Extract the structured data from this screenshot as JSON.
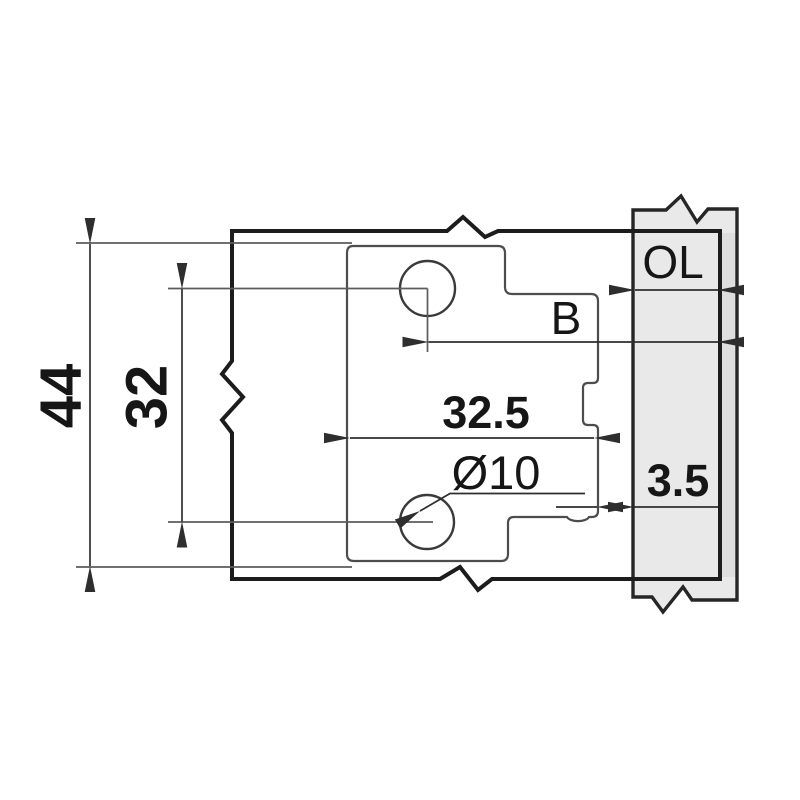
{
  "drawing": {
    "kind": "hinge-mounting-plate-dimension-diagram",
    "labels": {
      "plate_height": "44",
      "hole_spacing": "32",
      "plate_setback": "32.5",
      "hole_diameter": "Ø10",
      "boring_distance": "B",
      "overlay": "OL",
      "gap_offset": "3.5"
    },
    "colors": {
      "background": "#ffffff",
      "panel_fill": "#e9e9e9",
      "panel_edge_fill": "#dedede",
      "door_outline": "#1c1c1c",
      "panel_outline": "#262626",
      "plate_outline": "#4d4d4d",
      "dimension_lines": "#2e2e2e",
      "extension_lines": "#5c5c5c",
      "text": "#161616"
    }
  }
}
